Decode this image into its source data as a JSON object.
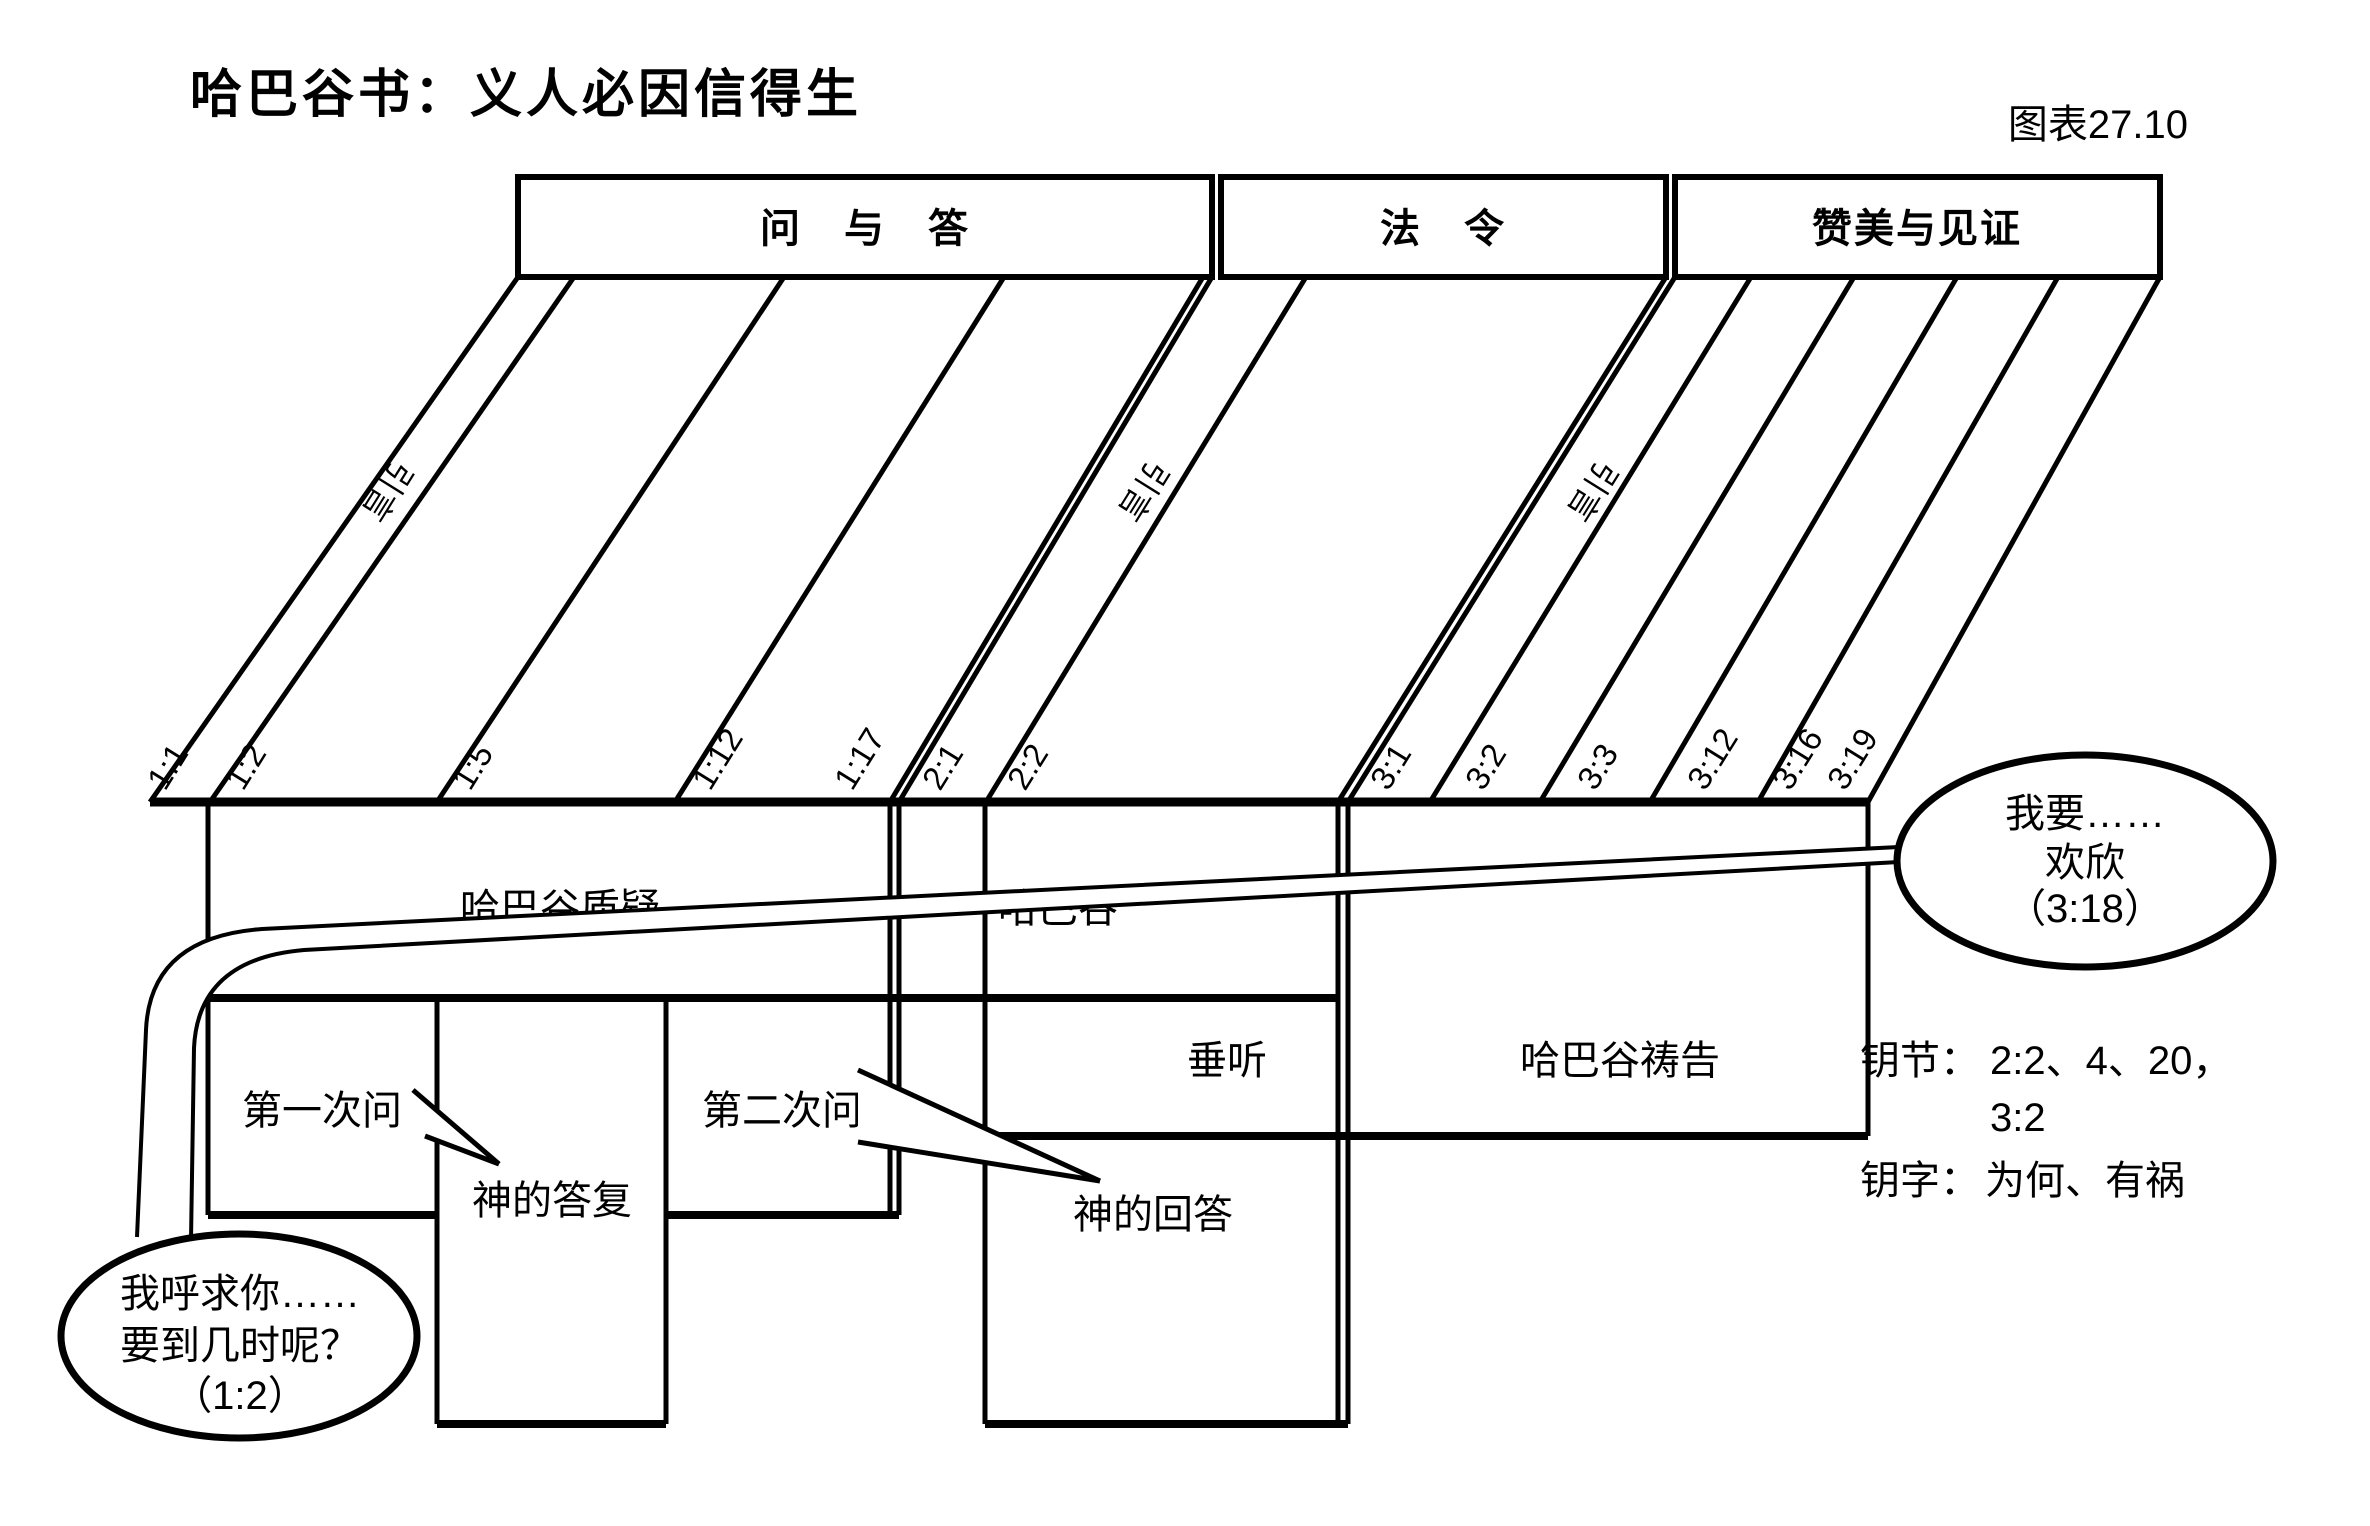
{
  "title": "哈巴谷书：义人必因信得生",
  "chart_number": "图表27.10",
  "colors": {
    "ink": "#000000",
    "paper": "#ffffff"
  },
  "sections": {
    "qa": "问　与　答",
    "decree": "法　令",
    "praise": "赞美与见证"
  },
  "intro_label": "引言",
  "verses": [
    "1:1",
    "1:2",
    "1:5",
    "1:12",
    "1:17",
    "2:1",
    "2:2",
    "3:1",
    "3:2",
    "3:3",
    "3:12",
    "3:16",
    "3:19"
  ],
  "bands": {
    "habakkuk_questions": "哈巴谷质疑",
    "habakkuk": "哈巴谷",
    "listens": "垂听",
    "habakkuk_prays": "哈巴谷祷告"
  },
  "labels": {
    "first_question": "第一次问",
    "gods_reply": "神的答复",
    "second_question": "第二次问",
    "gods_answer": "神的回答"
  },
  "bubbles": {
    "right": {
      "lines": [
        "我要……",
        "欢欣",
        "（3:18）"
      ]
    },
    "left": {
      "lines": [
        "我呼求你……",
        "要到几时呢？",
        "（1:2）"
      ]
    }
  },
  "keys": {
    "verses_label": "钥节：",
    "verses_line1": "2:2、4、20，",
    "verses_line2": "3:2",
    "words_label": "钥字：",
    "words_value": "为何、有祸"
  }
}
